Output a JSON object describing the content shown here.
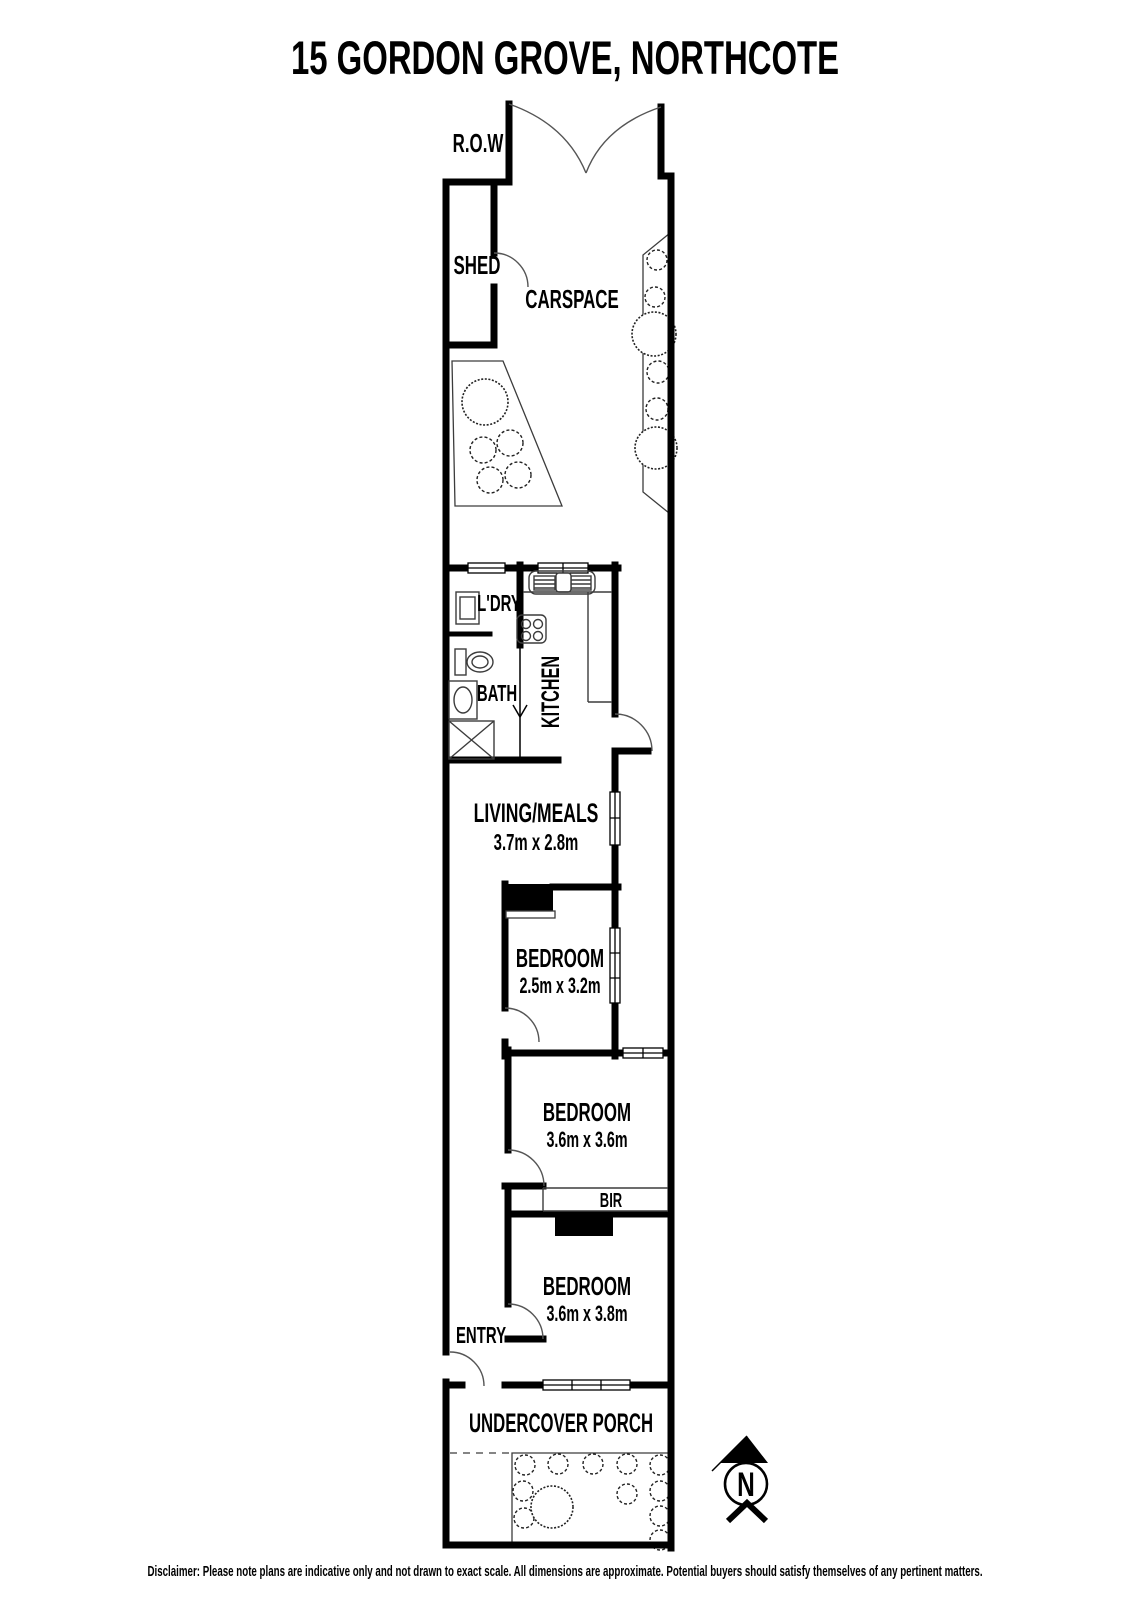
{
  "page": {
    "title": "15 GORDON GROVE, NORTHCOTE",
    "disclaimer": "Disclaimer: Please note plans are indicative only and not drawn to exact scale. All dimensions are approximate. Potential buyers should satisfy themselves of any pertinent matters."
  },
  "areas": {
    "row": "R.O.W",
    "shed": "SHED",
    "carspace": "CARSPACE",
    "laundry": "L'DRY",
    "kitchen": "KITCHEN",
    "bath": "BATH",
    "living": {
      "label": "LIVING/MEALS",
      "dims": "3.7m x 2.8m"
    },
    "bedroom1": {
      "label": "BEDROOM",
      "dims": "2.5m x 3.2m"
    },
    "bedroom2": {
      "label": "BEDROOM",
      "dims": "3.6m x 3.6m"
    },
    "bedroom3": {
      "label": "BEDROOM",
      "dims": "3.6m x 3.8m"
    },
    "bir": "BIR",
    "entry": "ENTRY",
    "porch": "UNDERCOVER PORCH"
  },
  "compass": {
    "north": "N"
  },
  "colors": {
    "wall": "#000000",
    "thin_line": "#3c3c3c",
    "background": "#ffffff"
  }
}
